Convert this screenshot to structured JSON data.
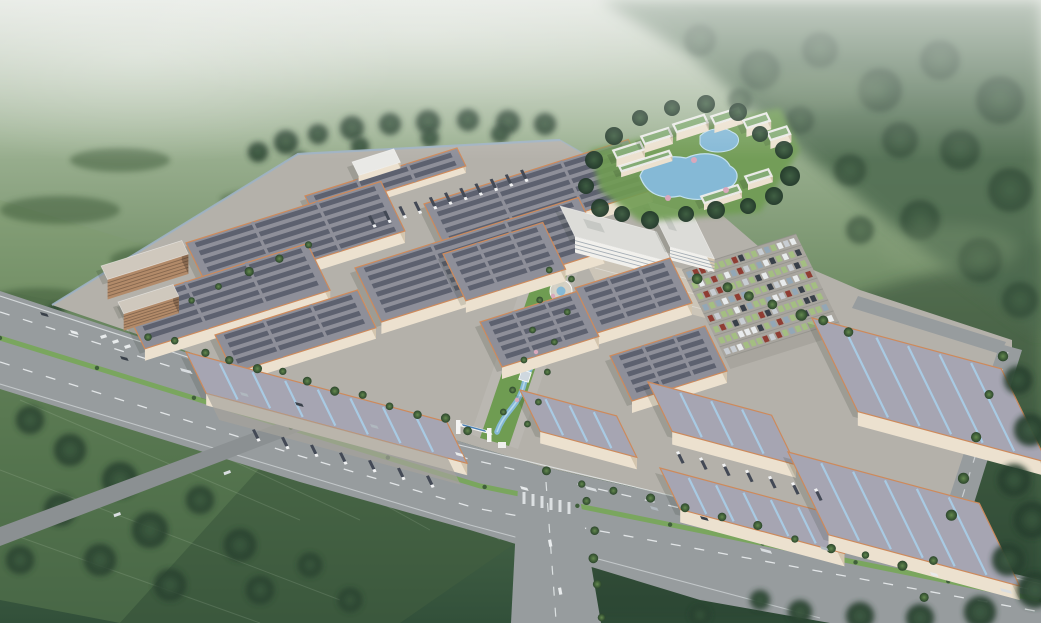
{
  "scene": {
    "kind": "architectural-aerial-rendering",
    "subject": "industrial-logistics-park",
    "elements": [
      "misty-hills-backdrop",
      "mountain-forest",
      "farm-fields",
      "perimeter-highway",
      "campus-platform",
      "warehouse-cluster-left",
      "warehouse-cluster-middle",
      "warehouse-cluster-right",
      "dormitory-building",
      "office-headquarters",
      "central-landscape-garden",
      "winding-stream",
      "parking-lot",
      "resort-hotel-with-ponds",
      "entrance-gate",
      "loading-dock-trucks",
      "highway-vehicles",
      "street-trees"
    ]
  },
  "palette": {
    "haze": "#c6cfc3",
    "bg_top": "#c2cbbd",
    "bg_hi": "#9db293",
    "bg_mid": "#6e8b63",
    "bg_low": "#4b6a4a",
    "bg_bot": "#32503a",
    "hill_light": "#89a17c",
    "forest": "#2f4a33",
    "forest_deep": "#22382a",
    "field_light": "#7d9a6e",
    "field_mid": "#5d7d52",
    "field_dark": "#43603f",
    "ground": "#b4b1aa",
    "apron": "#a5a29b",
    "plaza": "#ccc5b8",
    "road": "#979c9e",
    "road_dark": "#8b9092",
    "lane": "#eef2f3",
    "median": "#7aa65e",
    "wall": "#ece1cf",
    "wall_shadow": "#d3c5ae",
    "trim": "#cd8a5c",
    "roof_slate": "#8e8f99",
    "roof_panel": "#585c6a",
    "roof_light": "#a6a5b2",
    "skylight": "#a9cde6",
    "roof_white": "#e9e9e6",
    "roof_green": "#79a468",
    "roof_blue": "#4a80b5",
    "roof_red": "#a85a48",
    "roof_office": "#dcdcd8",
    "office_wall": "#f1f0ec",
    "dorm_wall": "#b28a69",
    "court": "#a2604c",
    "sport_green": "#5d8a60",
    "water": "#85b9d6",
    "water_light": "#c2e0ee",
    "lawn": "#6f9c52",
    "tree": "#4c7342",
    "tree_dark": "#2c462c",
    "blossom": "#d9a8bc",
    "car_white": "#e8ebec",
    "car_dark": "#394049",
    "car_blue": "#93a7b6",
    "car_red": "#8f3d33",
    "stall": "#a3c17e",
    "truck_trailer": "#434955",
    "truck_cab": "#f2f3f4",
    "shadow": "#1e2a1a",
    "wall_fence": "#9fb2c4"
  }
}
